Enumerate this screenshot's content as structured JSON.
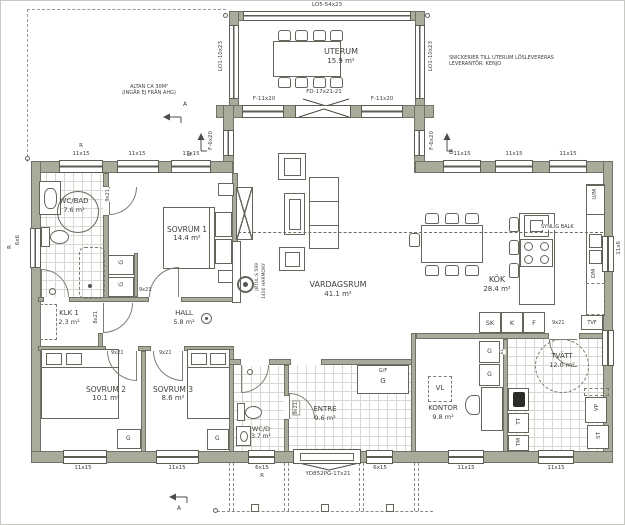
{
  "colors": {
    "wall": "#a9ac9b",
    "tile": "#d8d8d2",
    "text": "#3e3f39",
    "line": "#64665c"
  },
  "rooms": {
    "uterum": {
      "name": "UTERUM",
      "area": "15.9 m²"
    },
    "vardagsrum": {
      "name": "VARDAGSRUM",
      "area": "41.1 m²"
    },
    "kok": {
      "name": "KÖK",
      "area": "28.4 m²"
    },
    "sovrum1": {
      "name": "SOVRUM 1",
      "area": "14.4 m²"
    },
    "sovrum2": {
      "name": "SOVRUM 2",
      "area": "10.1 m²"
    },
    "sovrum3": {
      "name": "SOVRUM 3",
      "area": "8.6 m²"
    },
    "wcbad": {
      "name": "WC/BAD",
      "area": "7.6 m²"
    },
    "klk": {
      "name": "KLK 1",
      "area": "2.3 m²"
    },
    "hall": {
      "name": "HALL",
      "area": "5.8 m²"
    },
    "wcd": {
      "name": "WC/D",
      "area": "3.7 m²"
    },
    "entre": {
      "name": "ENTRÉ",
      "area": "9.6 m²"
    },
    "kontor": {
      "name": "KONTOR",
      "area": "9.8 m²"
    },
    "tvatt": {
      "name": "TVÄTT",
      "area": "12.0 m²"
    }
  },
  "annotations": {
    "altan1": "ALTAN CA 30M²",
    "altan2": "(INGÅR EJ FRÅN AHG)",
    "snick1": "SNICKERIER TILL UTERUM LÖSLEVERERAS",
    "snick2": "LEVERANTÖR: KENJO",
    "balk": "SYNLIG BALK",
    "jotul1": "JØTUL S 599",
    "jotul2": "1400 HARMONY"
  },
  "windows": {
    "lo5": "LO5-54x23",
    "lo1": "LO1-10x23",
    "f11x20": "F-11x20",
    "f6x20": "F-6x20",
    "fd": "FD-17x21-21",
    "w11x15": "11x15",
    "w6x15": "6x15",
    "w11x6": "11x6",
    "w6x6": "6x6",
    "r": "R"
  },
  "doors": {
    "main": "YD852PG-17x21",
    "d9x21": "9x21",
    "d8x21": "8x21"
  },
  "fixtures": {
    "um": "U/M",
    "dm": "DM",
    "sk": "SK",
    "k": "K",
    "f": "F",
    "g": "G",
    "gf": "G/F",
    "vl": "VL",
    "tt": "TT",
    "tm": "TM",
    "vp": "VP",
    "st": "ST",
    "tvf": "TVF",
    "el": "EL"
  },
  "markers": {
    "a": "A",
    "b": "B"
  }
}
